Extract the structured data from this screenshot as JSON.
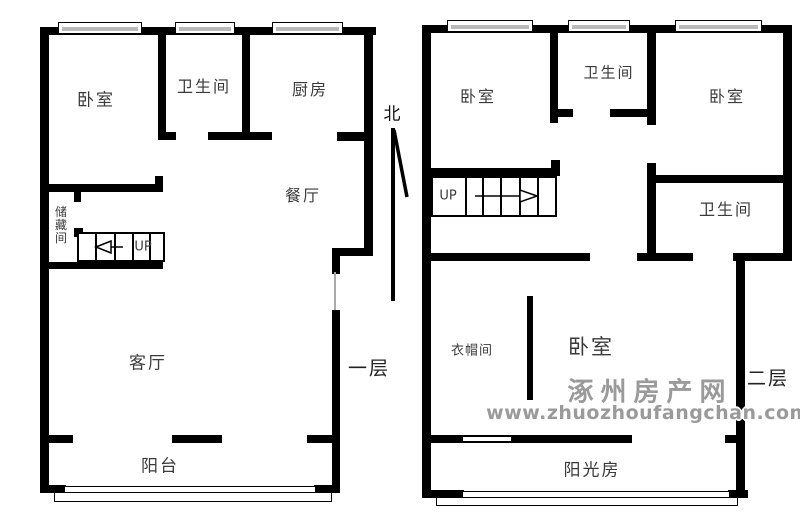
{
  "compass": {
    "north_label": "北"
  },
  "floor1": {
    "floor_label": "一层",
    "stairs_label": "UP",
    "rooms": {
      "bedroom": "卧室",
      "bathroom": "卫生间",
      "kitchen": "厨房",
      "dining_room": "餐厅",
      "storage_room": "储藏间",
      "living_room": "客厅",
      "balcony": "阳台"
    }
  },
  "floor2": {
    "floor_label": "二层",
    "stairs_label": "UP",
    "rooms": {
      "bedroom_left": "卧室",
      "bathroom_top": "卫生间",
      "bedroom_right": "卧室",
      "bathroom_right": "卫生间",
      "cloakroom": "衣帽间",
      "bedroom_main": "卧室",
      "sunroom": "阳光房"
    }
  },
  "watermark": {
    "site_name": "涿州房产网",
    "site_url": "www.zhuozhoufangchan.com"
  },
  "colors": {
    "wall": "#000000",
    "label_text": "#3a3a3a",
    "window_glass": "#b9b9b9",
    "watermark_gray": "#9a9a9a"
  }
}
